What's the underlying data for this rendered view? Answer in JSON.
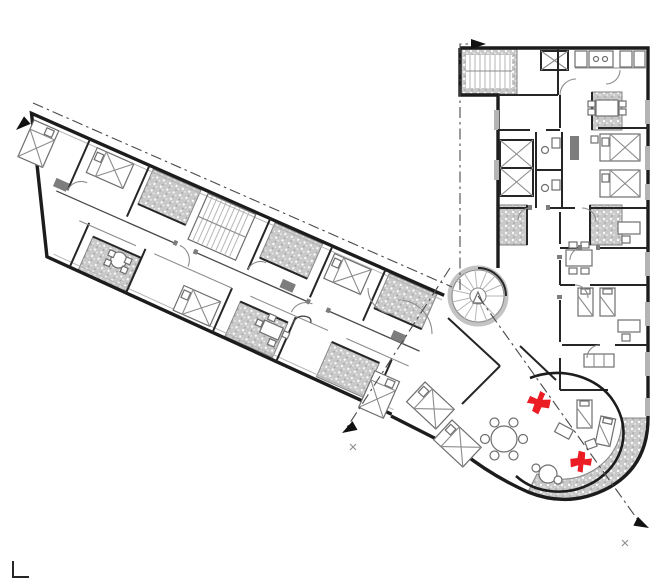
{
  "drawing": {
    "colors": {
      "background": "#ffffff",
      "wall": "#1c1c1c",
      "partition": "#262626",
      "secondary": "#8c8c8c",
      "furniture": "#6e6e6e",
      "light_gray": "#b6b6b6",
      "balcony_base": "#c9c9c9",
      "balcony_speckle_light": "#ffffff",
      "balcony_speckle_dark": "#9b9b9b",
      "section_line": "#4a4a4a",
      "red": "#ec1c24"
    },
    "red_markers": [
      {
        "name": "red-marker-upper",
        "x": 538,
        "y": 402,
        "transform": "translate(538,402) rotate(-15)"
      },
      {
        "name": "red-marker-lower",
        "x": 582,
        "y": 462,
        "transform": "translate(582,462) rotate(150) scale(0.95)"
      }
    ],
    "section_arrows": [
      {
        "name": "arrow-top-left",
        "transform": "translate(16,130) rotate(139)"
      },
      {
        "name": "arrow-top-right",
        "transform": "translate(486,44) rotate(0)"
      },
      {
        "name": "arrow-bottom-left",
        "transform": "translate(342,433) rotate(150)"
      },
      {
        "name": "arrow-bottom-right",
        "transform": "translate(649,528) rotate(27)"
      }
    ],
    "corner_mark": {
      "x": 13,
      "y": 561,
      "d": "M13,561 L13,577 L29,577"
    }
  }
}
